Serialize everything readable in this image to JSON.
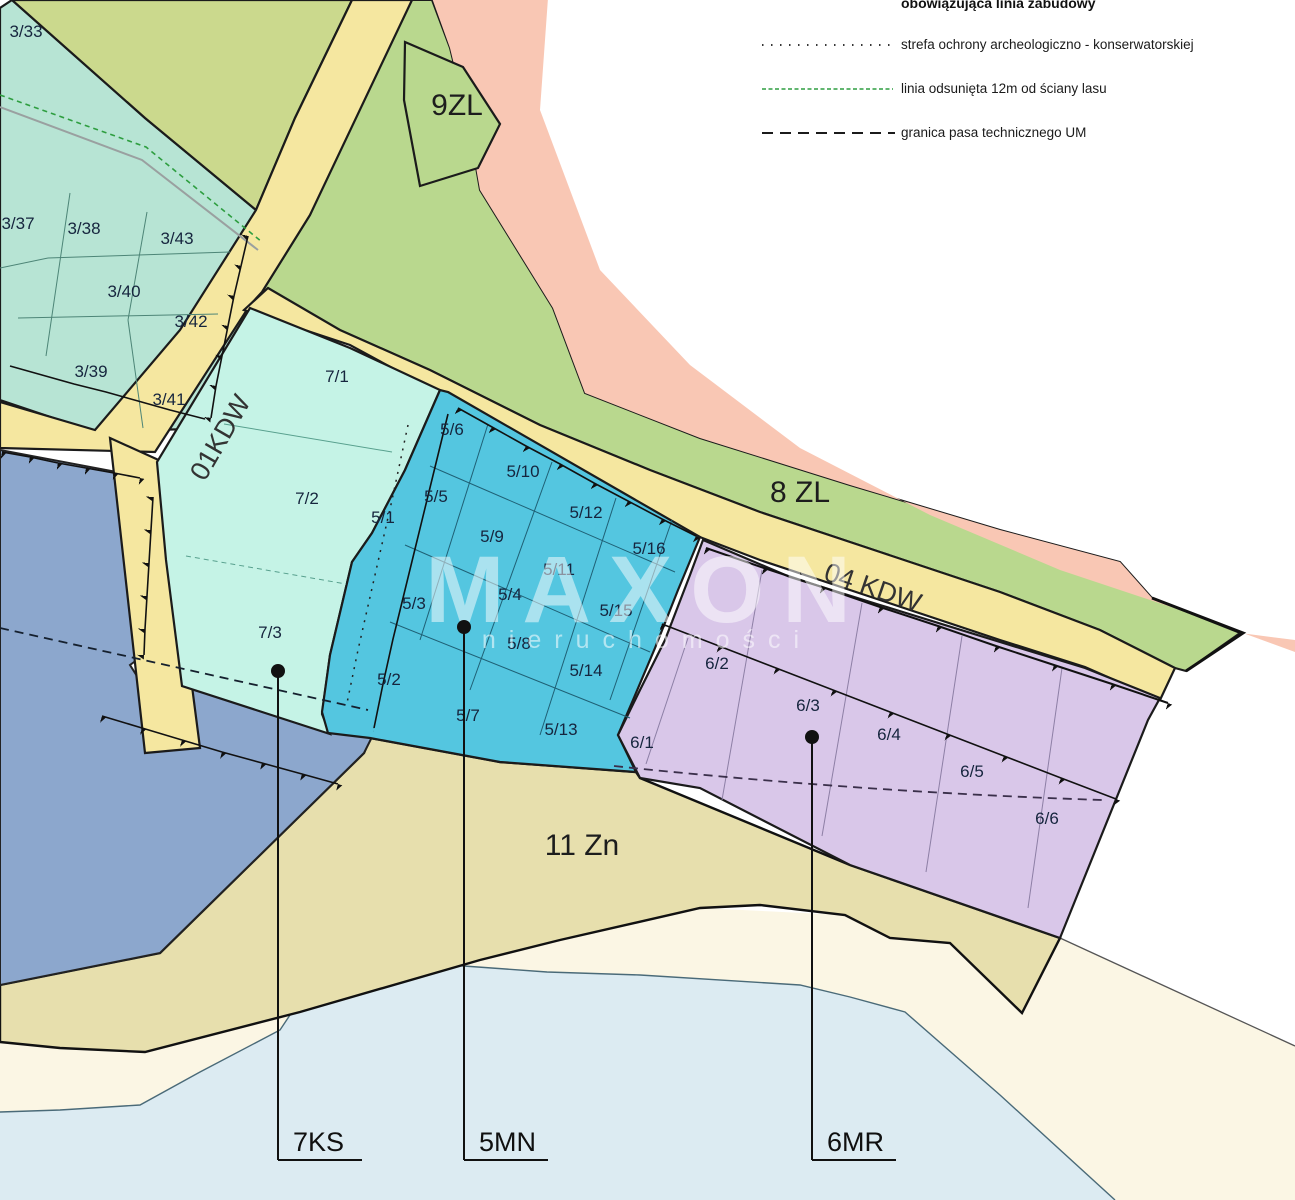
{
  "legend": {
    "items": [
      {
        "id": "building-line",
        "label": "obowiązująca linia zabudowy",
        "symbol": "bold-line-cut-off"
      },
      {
        "id": "archaeological-zone",
        "label": "strefa ochrony archeologiczno - konserwatorskiej",
        "symbol": "dotted-line",
        "color": "#1b1b1b"
      },
      {
        "id": "forest-offset-line",
        "label": "linia odsunięta 12m od ściany lasu",
        "symbol": "green-fine-dashed-line",
        "color": "#2e9e40"
      },
      {
        "id": "technical-strip",
        "label": "granica pasa technicznego UM",
        "symbol": "black-dashed-line",
        "color": "#1b1b1b"
      }
    ]
  },
  "zones": {
    "z9zl": {
      "label": "9ZL",
      "color": "#b9d88e"
    },
    "z8zl": {
      "label": "8 ZL",
      "color": "#b9d88e"
    },
    "z11zn": {
      "label": "11 Zn",
      "color": "#e7dfad"
    },
    "road01": {
      "label": "01KDW",
      "color": "#f5e7a0"
    },
    "road04": {
      "label": "04 KDW",
      "color": "#f5e7a0"
    },
    "z7ks": {
      "label": "7KS",
      "color": "#c5f3e6"
    },
    "z5mn": {
      "label": "5MN",
      "color": "#54c6e0"
    },
    "z6mr": {
      "label": "6MR",
      "color": "#d9c7e9"
    },
    "teal_estate": {
      "color": "#b7e4d4"
    },
    "olive": {
      "color": "#cbd98d"
    },
    "bluegray": {
      "color": "#8ca7cd"
    },
    "pink": {
      "color": "#f9c7b4"
    },
    "cream": {
      "color": "#fbf6e4"
    },
    "water": {
      "color": "#dcebf2"
    }
  },
  "parcels": {
    "area3": [
      {
        "label": "3/33",
        "x": 26,
        "y": 37
      },
      {
        "label": "3/37",
        "x": 18,
        "y": 229
      },
      {
        "label": "3/38",
        "x": 84,
        "y": 234
      },
      {
        "label": "3/43",
        "x": 177,
        "y": 244
      },
      {
        "label": "3/40",
        "x": 124,
        "y": 297
      },
      {
        "label": "3/42",
        "x": 191,
        "y": 327
      },
      {
        "label": "3/39",
        "x": 91,
        "y": 377
      },
      {
        "label": "3/41",
        "x": 169,
        "y": 405
      }
    ],
    "area7": [
      {
        "label": "7/1",
        "x": 337,
        "y": 382
      },
      {
        "label": "7/2",
        "x": 307,
        "y": 504
      },
      {
        "label": "7/3",
        "x": 270,
        "y": 638
      }
    ],
    "area5": [
      {
        "label": "5/1",
        "x": 383,
        "y": 523
      },
      {
        "label": "5/2",
        "x": 389,
        "y": 685
      },
      {
        "label": "5/3",
        "x": 414,
        "y": 609
      },
      {
        "label": "5/4",
        "x": 510,
        "y": 600
      },
      {
        "label": "5/5",
        "x": 436,
        "y": 502
      },
      {
        "label": "5/6",
        "x": 452,
        "y": 435
      },
      {
        "label": "5/7",
        "x": 468,
        "y": 721
      },
      {
        "label": "5/8",
        "x": 519,
        "y": 649
      },
      {
        "label": "5/9",
        "x": 492,
        "y": 542
      },
      {
        "label": "5/10",
        "x": 523,
        "y": 477
      },
      {
        "label": "5/11",
        "x": 559,
        "y": 575
      },
      {
        "label": "5/12",
        "x": 586,
        "y": 518
      },
      {
        "label": "5/13",
        "x": 561,
        "y": 735
      },
      {
        "label": "5/14",
        "x": 586,
        "y": 676
      },
      {
        "label": "5/15",
        "x": 616,
        "y": 616
      },
      {
        "label": "5/16",
        "x": 649,
        "y": 554
      }
    ],
    "area6": [
      {
        "label": "6/1",
        "x": 642,
        "y": 748
      },
      {
        "label": "6/2",
        "x": 717,
        "y": 669
      },
      {
        "label": "6/3",
        "x": 808,
        "y": 711
      },
      {
        "label": "6/4",
        "x": 889,
        "y": 740
      },
      {
        "label": "6/5",
        "x": 972,
        "y": 777
      },
      {
        "label": "6/6",
        "x": 1047,
        "y": 824
      }
    ]
  },
  "callouts": [
    {
      "label": "7KS",
      "x": 278,
      "dotY": 671
    },
    {
      "label": "5MN",
      "x": 464,
      "dotY": 627
    },
    {
      "label": "6MR",
      "x": 812,
      "dotY": 737
    }
  ],
  "watermark": {
    "name": "MAXON",
    "subtitle": "nieruchomości"
  }
}
